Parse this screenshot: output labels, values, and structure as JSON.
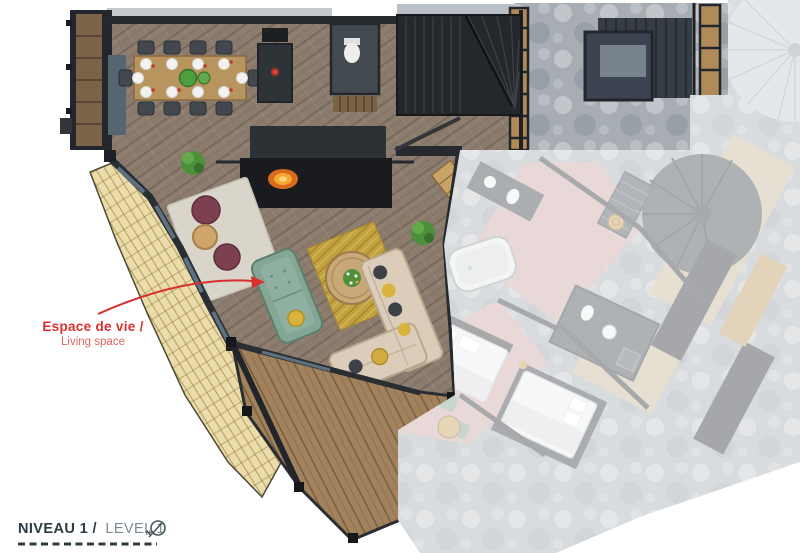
{
  "annotation": {
    "label_fr": "Espace de vie /",
    "label_en": "Living space",
    "color": "#d92f2f",
    "color_light": "#df6464"
  },
  "legend": {
    "level_fr": "NIVEAU 1 /",
    "level_en": "LEVEL 1",
    "compass": "N",
    "text_dark": "#2c3a42",
    "text_light": "#7b8a91"
  },
  "colors": {
    "wood_floor": "#8b7b6d",
    "deck_wood": "#a2825c",
    "roof_shingles": "#ead9a3",
    "sofa_green": "#84a795",
    "sofa_beige": "#dccdbb",
    "rug_gold": "#c2a23f",
    "pouf_burgundy": "#7c4050",
    "wall_dark": "#26292d",
    "stone": "#a7adb3",
    "pink_floor": "#c9a4a4",
    "fire": "#f5a832",
    "fade_overlay": "rgba(255,255,255,0.57)"
  }
}
